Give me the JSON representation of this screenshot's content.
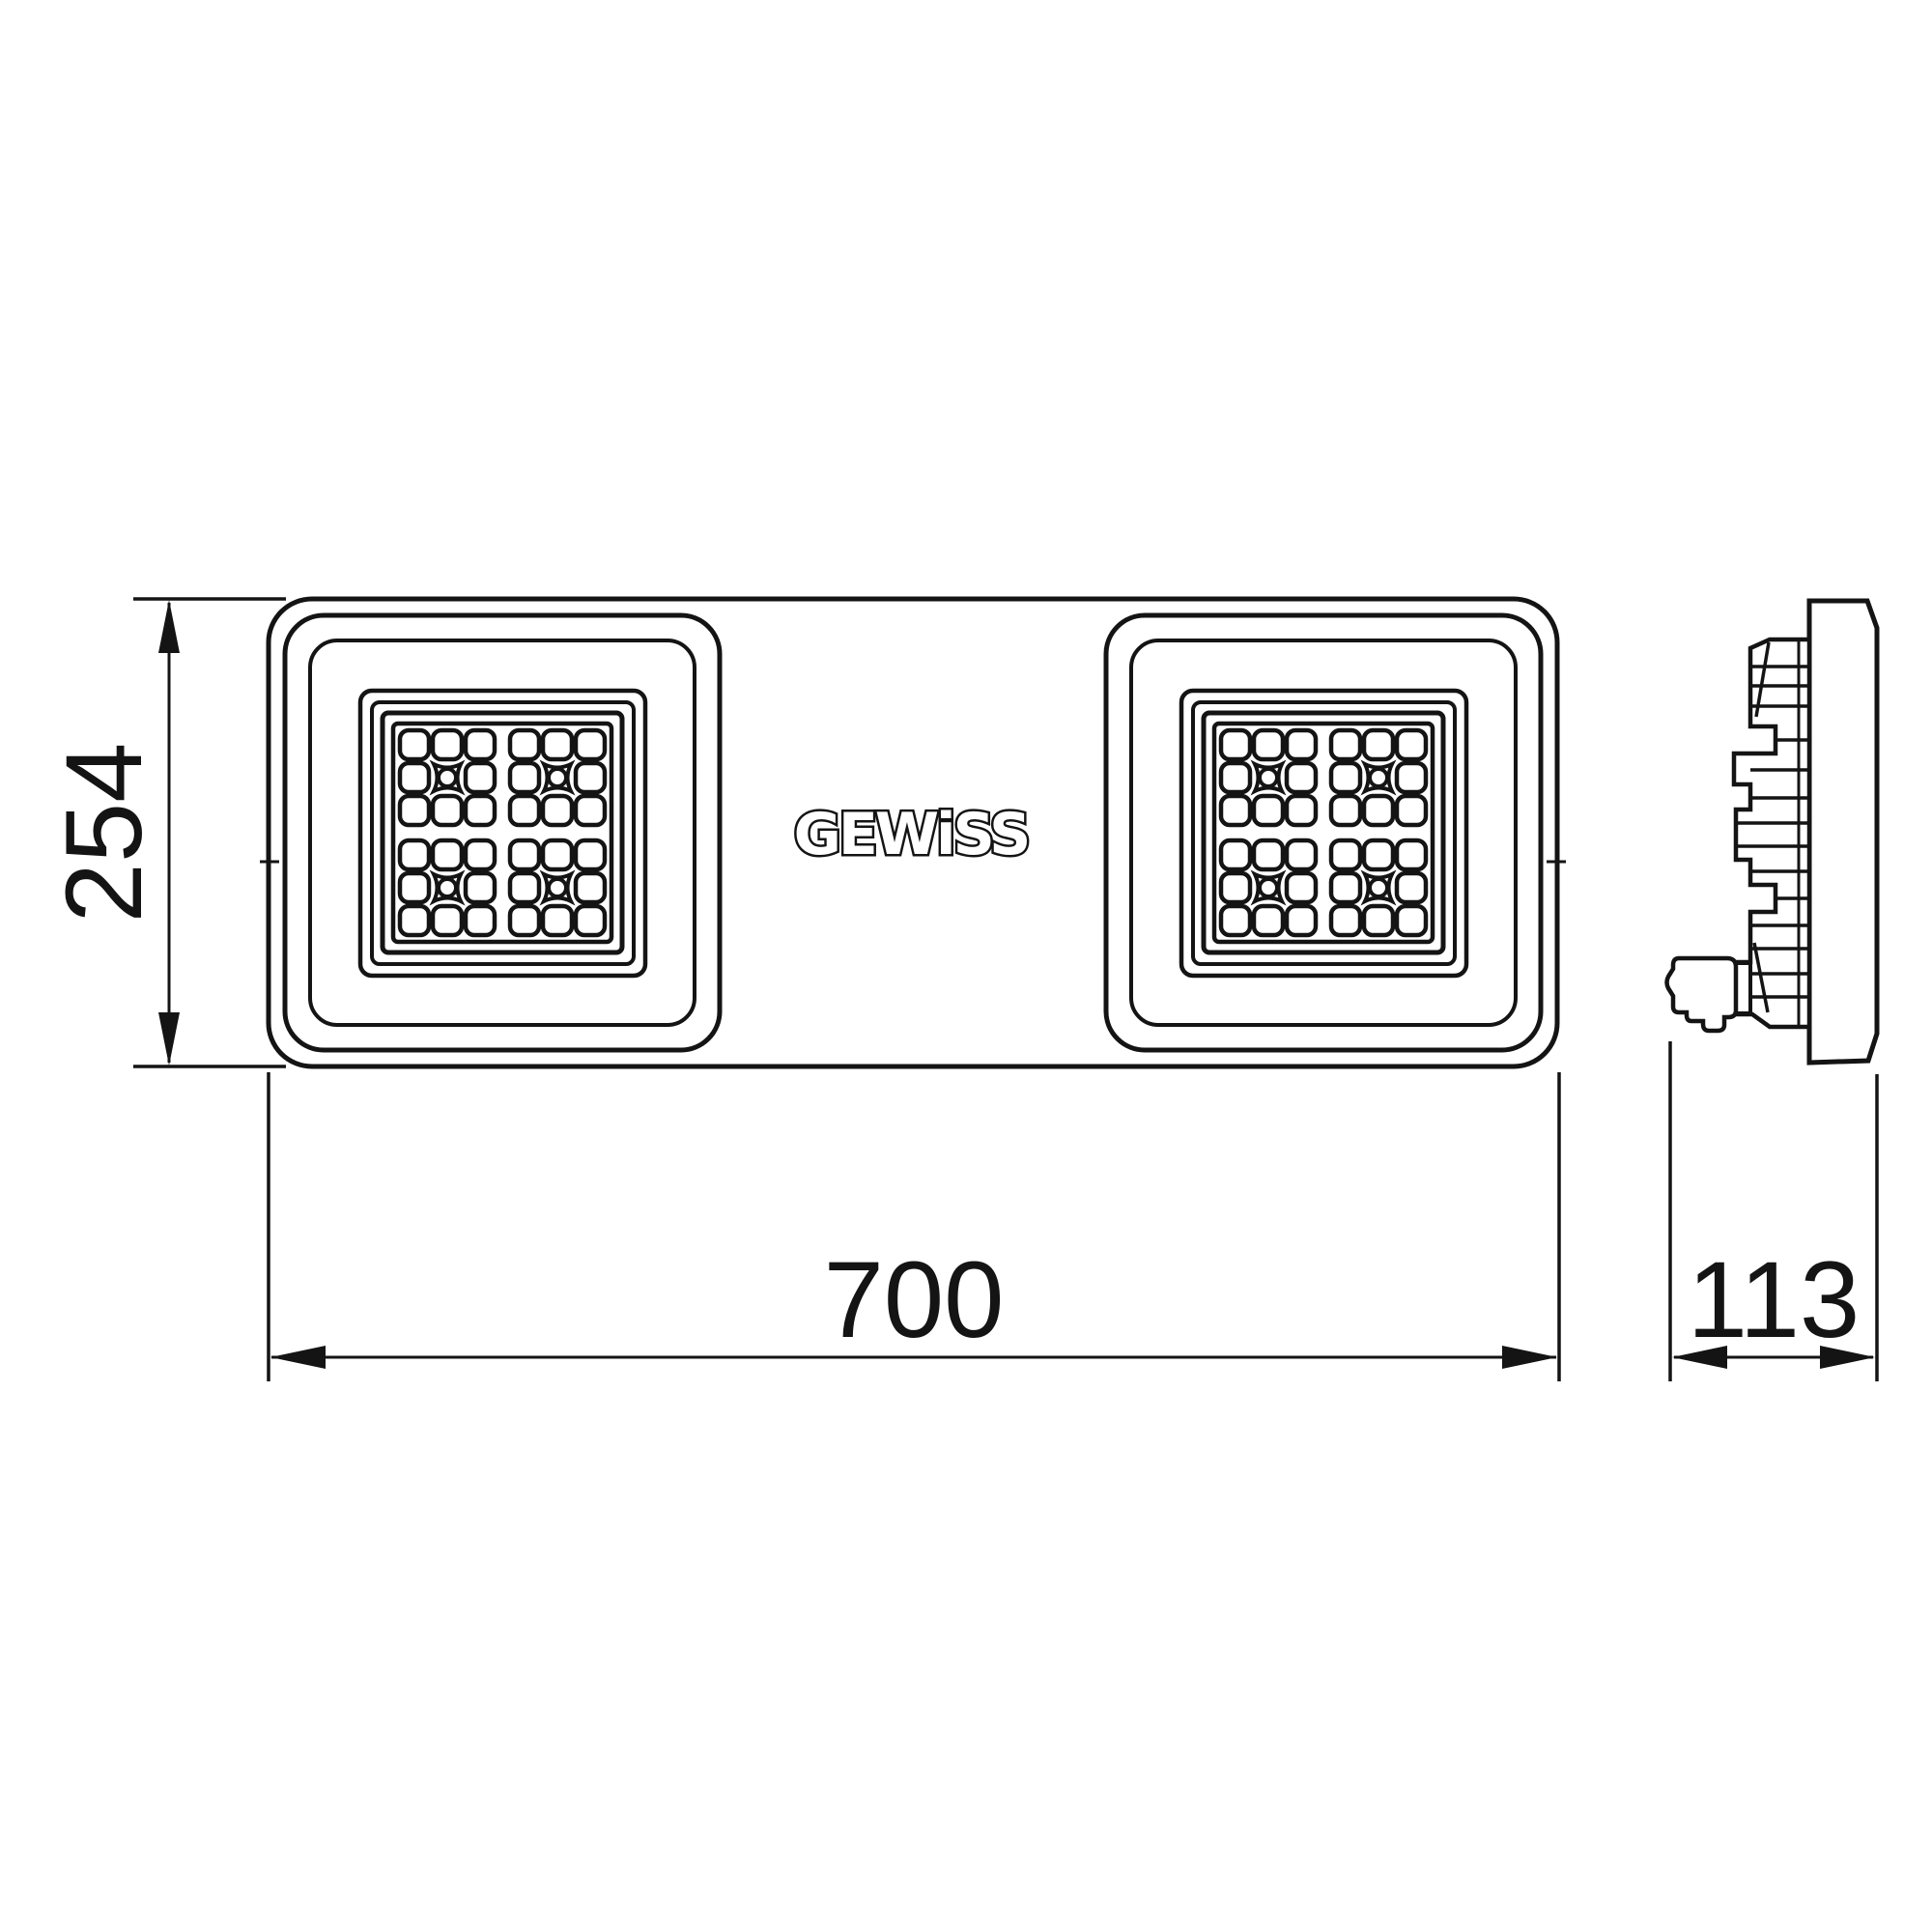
{
  "page": {
    "background": "#ffffff",
    "line_color": "#141414"
  },
  "brand": {
    "logo_text": "GEWiSS"
  },
  "dimensions": {
    "height": {
      "label": "254"
    },
    "width": {
      "label": "700"
    },
    "depth": {
      "label": "113"
    }
  }
}
